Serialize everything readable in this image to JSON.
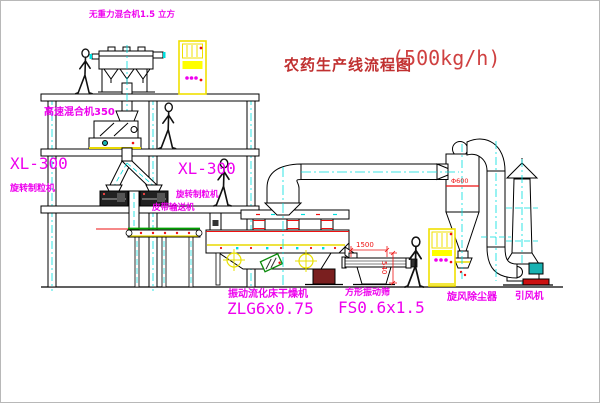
{
  "title": {
    "name": "农药生产线流程图",
    "capacity": "(500kg/h)"
  },
  "labels": {
    "gravity_free_mixer": "无重力混合机1.5 立方",
    "high_speed_mixer": "高速混合机350",
    "granulator_left_model": "XL-300",
    "granulator_left_name": "旋转制粒机",
    "granulator_mid_model": "XL-300",
    "granulator_mid_name": "旋转制粒机",
    "belt_conveyor": "皮带输送机",
    "dryer_name": "振动流化床干燥机",
    "dryer_model": "ZLG6x0.75",
    "screen_name": "方形振动筛",
    "screen_model": "FS0.6x1.5",
    "cyclone": "旋风除尘器",
    "fan": "引风机"
  },
  "dims": {
    "screen_length": "1500",
    "screen_height": "540",
    "cyclone_dia": "Φ600"
  },
  "colors": {
    "label_magenta": "#ee00ee",
    "title_red": "#c03030",
    "centerline_cyan": "#00dede",
    "cad_yellow": "#f0e000",
    "line_black": "#000000",
    "accent_red": "#ee1111",
    "belt_green": "#00a000",
    "motor_teal": "#18b2b2"
  }
}
